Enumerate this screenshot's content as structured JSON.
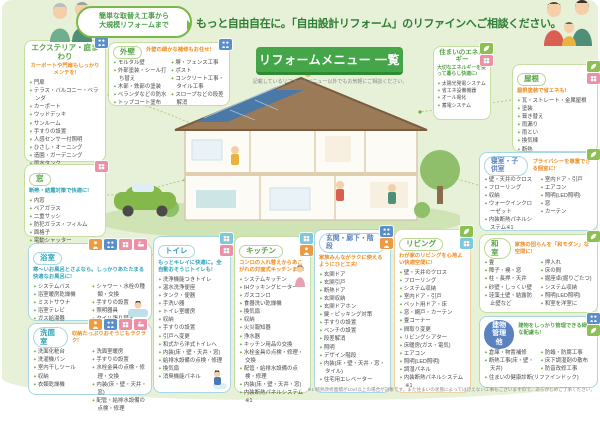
{
  "header": {
    "bubble_line1": "簡単な取替え工事から",
    "bubble_line2": "大規模リフォームまで",
    "headline": "もっと自由自在に。「自由設計リフォーム」のリファインへご相談ください。",
    "menu_title": "リフォームメニュー 一覧",
    "menu_subtitle": "記載しているリフォームメニュー以外でもお気軽にご相談ください。"
  },
  "footnote": "※1 断熱改修面積が10㎡以上の場合が対象です。また住まいの状態によっては行えない工事もございますので、あらかじめご了承ください。",
  "colors": {
    "background": "#e7f1d8",
    "accent_green": "#44a648",
    "accent_teal": "#2fa3b7",
    "accent_orange": "#ef8d1e",
    "accent_blue": "#5a82c0"
  },
  "sections": {
    "exterior": {
      "title": "エクステリア・庭まわり",
      "catch": "カーポートや門扉もしっかりメンテを!",
      "items": [
        "門扉",
        "テラス・バルコニー・ベランダ",
        "カーポート",
        "ウッドデッキ",
        "サンルーム",
        "手すりの設置",
        "人感センサー付照明",
        "ひさし・オーニング",
        "造園・ガーデニング",
        "雨水タンク"
      ],
      "badges": [
        {
          "color": "#5b8fc9",
          "icon": "family-icon"
        }
      ]
    },
    "gaiheki": {
      "title": "外壁",
      "catch": "外壁の細かな補修もお任せ!",
      "items": [
        "モルタル壁",
        "外部塗装・シール打ち替え",
        "木部・鉄部の塗装",
        "ベランダなどの防水",
        "トップコート塗布"
      ],
      "items2": [
        "塀・フェンス工事",
        "ポスト",
        "コンクリート工事・タイル工事",
        "スロープなどの段差解消"
      ],
      "badges": [
        {
          "color": "#5b8fc9",
          "icon": "family-icon"
        }
      ]
    },
    "mado": {
      "title": "窓",
      "catch": "断熱・結露対策で快適に!",
      "items": [
        "内窓",
        "ペアガラス",
        "二重サッシ",
        "防犯ガラス・フィルム",
        "面格子",
        "電動シャッター",
        "網戸"
      ],
      "badges": [
        {
          "color": "#ee8fa8",
          "icon": "box-icon"
        }
      ]
    },
    "yokushitsu": {
      "title": "浴室",
      "catch": "寒〜いお風呂とさよなら。しっかりあたたまる快適なお風呂に!",
      "items": [
        "システムバス",
        "浴室暖房乾燥機",
        "ミストサウナ",
        "浴室テレビ",
        "ガス給湯器",
        "エコキュート",
        "鏡のくもり・汚れ"
      ],
      "items2": [
        "シャワー・水栓の種類・交換",
        "手すりの設置",
        "照明器具",
        "タイル張り替え",
        "壁・天井・床"
      ],
      "badges": [
        {
          "color": "#eb9b43",
          "icon": "person-icon"
        },
        {
          "color": "#5b8fc9",
          "icon": "family-icon"
        },
        {
          "color": "#ee8fa8",
          "icon": "box-icon"
        },
        {
          "color": "#ee8fa8",
          "icon": "bath-icon"
        }
      ]
    },
    "senmen": {
      "title": "洗面室",
      "catch": "収納たっぷりおそうじもラクラク!",
      "items": [
        "洗面化粧台",
        "洗濯機パン",
        "室内干しツール",
        "収納",
        "衣類乾燥機"
      ],
      "items2": [
        "洗面室暖房",
        "手すりの設置",
        "水栓金具の点検・修理・交換",
        "内装(床・壁・天井・窓)",
        "配管・給排水設備の点検・修理"
      ],
      "badges": [
        {
          "color": "#eb9b43",
          "icon": "person-icon"
        },
        {
          "color": "#5b8fc9",
          "icon": "family-icon"
        },
        {
          "color": "#ee8fa8",
          "icon": "box-icon"
        },
        {
          "color": "#ee8fa8",
          "icon": "bath-icon"
        }
      ]
    },
    "toilet": {
      "title": "トイレ",
      "catch": "もっとキレイに快適に。全自動おそうじトイレも!",
      "items": [
        "洗浄機能つきトイレ",
        "温水洗浄便座",
        "タンク・便器",
        "手洗い器",
        "トイレ室暖房",
        "収納",
        "手すりの設置",
        "引戸へ変更",
        "和式から洋式トイレへ",
        "内装(床・壁・天井・窓)",
        "給排水設備の点検・修理",
        "換気扇",
        "消臭機能パネル"
      ],
      "badges": [
        {
          "color": "#7ec8de",
          "icon": "box-icon"
        },
        {
          "color": "#ee8fa8",
          "icon": "box-icon"
        }
      ]
    },
    "kitchen": {
      "title": "キッチン",
      "catch": "コンロの入れ替えからあこがれの対面式キッチンまで!",
      "items": [
        "システムキッチン",
        "IHクッキングヒーター",
        "ガスコンロ",
        "食器洗い乾燥機",
        "換気扇",
        "収納",
        "火災報知器",
        "浄水器",
        "キッチン用品の交換",
        "水栓金具の点検・修理・交換",
        "配管・給排水設備の点検・修理",
        "内装(床・壁・天井・窓)",
        "内装断熱パネルシステム※1"
      ],
      "badges": [
        {
          "color": "#7ec8de",
          "icon": "box-icon"
        },
        {
          "color": "#eb9b43",
          "icon": "person-icon"
        }
      ]
    },
    "genkan": {
      "title": "玄関・廊下・階段",
      "catch": "家族みんながラクに使えるようにひと工夫!",
      "items": [
        "玄関ドア",
        "玄関引戸",
        "断熱ドア",
        "玄関収納",
        "玄関ドアホン",
        "鍵・ピッキング対策",
        "手すりの設置",
        "ベンチの設置",
        "段差解消",
        "照明",
        "デザイン階段",
        "内装(床・壁・天井・窓・タイル)",
        "住宅用エレベーター"
      ],
      "badges": [
        {
          "color": "#5b8fc9",
          "icon": "family-icon"
        },
        {
          "color": "#eb9b43",
          "icon": "person-icon"
        }
      ]
    },
    "living": {
      "title": "リビング",
      "catch": "わが家のリビングを心地よい快適空間に!",
      "items": [
        "壁・天井のクロス",
        "フローリング",
        "システム収納",
        "室内ドア・引戸",
        "ペット用ドア・床",
        "窓・網戸・カーテン",
        "畳コーナー",
        "間取り変更",
        "リビングシアター",
        "床暖房(ガス・電気)",
        "エアコン",
        "照明(LED照明)",
        "調湿パネル",
        "内装断熱パネルシステム※1"
      ],
      "badges": [
        {
          "color": "#8cc152",
          "icon": "leaf-icon"
        },
        {
          "color": "#7ec8de",
          "icon": "box-icon"
        }
      ]
    },
    "energy": {
      "title": "住まいのエネルギー",
      "catch": "大切なエネルギーを使って暮らし快適に!",
      "items": [
        "太陽光発電システム",
        "省エネ設備機器",
        "オール電化",
        "蓄電システム"
      ],
      "badges": [
        {
          "color": "#8cc152",
          "icon": "leaf-icon"
        },
        {
          "color": "#ee8fa8",
          "icon": "box-icon"
        }
      ]
    },
    "yane": {
      "title": "屋根",
      "catch": "屋根塗装で省エネも!",
      "items": [
        "瓦・ストレート・金属屋根",
        "塗装",
        "葺き替え",
        "雨漏り",
        "雨とい",
        "換気棟",
        "断熱",
        "太陽光発電システム"
      ],
      "badges": [
        {
          "color": "#8cc152",
          "icon": "leaf-icon"
        },
        {
          "color": "#ee8fa8",
          "icon": "box-icon"
        }
      ]
    },
    "shinshitsu": {
      "title": "寝室・子供室",
      "catch": "プライバシーを尊重できる個室に!",
      "items": [
        "壁・天井のクロス",
        "フローリング",
        "収納",
        "ウォークインクローゼット",
        "内装断熱パネルシステム※1"
      ],
      "items2": [
        "室内ドア・引戸",
        "エアコン",
        "照明(LED照明)",
        "窓",
        "カーテン"
      ],
      "badges": [
        {
          "color": "#8cc152",
          "icon": "leaf-icon"
        }
      ]
    },
    "washitsu": {
      "title": "和室",
      "catch": "家族の団らんを「和モダン」な空間に!",
      "items": [
        "畳",
        "障子・襖・窓",
        "柱・長押・天井",
        "砂壁・しっくい壁",
        "珪藻土壁・結露防止壁など"
      ],
      "items2": [
        "押入れ",
        "床の間",
        "掘座卓(掘りごたつ)",
        "システム収納",
        "照明(LED照明)",
        "和室を洋室に"
      ],
      "badges": [
        {
          "color": "#8cc152",
          "icon": "leaf-icon"
        }
      ]
    },
    "tatemono": {
      "title_line1": "建物",
      "title_line2": "管理他",
      "catch": "建物をしっかり管理できる細かな配慮も!",
      "items": [
        "倉庫・物置補修",
        "断熱工事(床・壁・天井)"
      ],
      "items2": [
        "防蟻・防腐工事",
        "床下調湿剤の散布",
        "防音改修工事"
      ],
      "extra": "住まいの健康診断(リファインドック)",
      "badges": [
        {
          "color": "#5b8fc9",
          "icon": "family-icon"
        },
        {
          "color": "#8cc152",
          "icon": "leaf-icon"
        }
      ]
    }
  }
}
